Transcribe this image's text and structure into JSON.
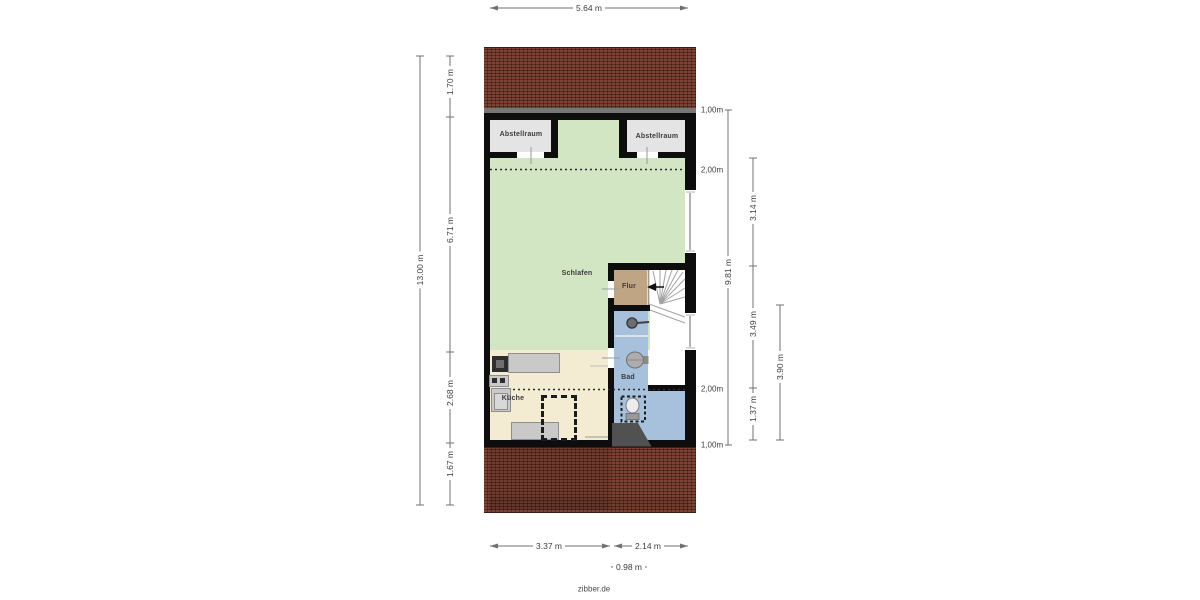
{
  "brand": {
    "label": "zibber.de"
  },
  "rooms": {
    "abstellraum_left": {
      "label": "Abstellraum"
    },
    "abstellraum_right": {
      "label": "Abstellraum"
    },
    "schlafen": {
      "label": "Schlafen"
    },
    "flur": {
      "label": "Flur"
    },
    "bad": {
      "label": "Bad"
    },
    "kueche": {
      "label": "Küche"
    }
  },
  "fixtures": {
    "shower": "shower-head",
    "washbasin": "washbasin",
    "toilet": "toilet",
    "stairs": "winder-stairs",
    "kitchen_counter": "kitchen-counter"
  },
  "dimensions": {
    "width_total": "5.64 m",
    "height_total": "13.00 m",
    "left_segments": [
      "1.70 m",
      "6.71 m",
      "2.68 m",
      "1.67 m"
    ],
    "right_height_marks": [
      "1,00m",
      "2,00m",
      "2,00m",
      "1,00m"
    ],
    "right_span": "9.81 m",
    "right_segments": [
      "3.14 m",
      "3.49 m",
      "1.37 m"
    ],
    "right_outer": "3.90 m",
    "bottom_segments": [
      "3.37 m",
      "2.14 m"
    ],
    "bottom_small": "0.98 m"
  },
  "colors": {
    "brick": "#7b4436",
    "green": "#d3e6c4",
    "storage": "#e4e4e4",
    "flur": "#c0a584",
    "kueche": "#f3ebd2",
    "bad": "#a7c1dc",
    "wall": "#0d0d0d"
  }
}
